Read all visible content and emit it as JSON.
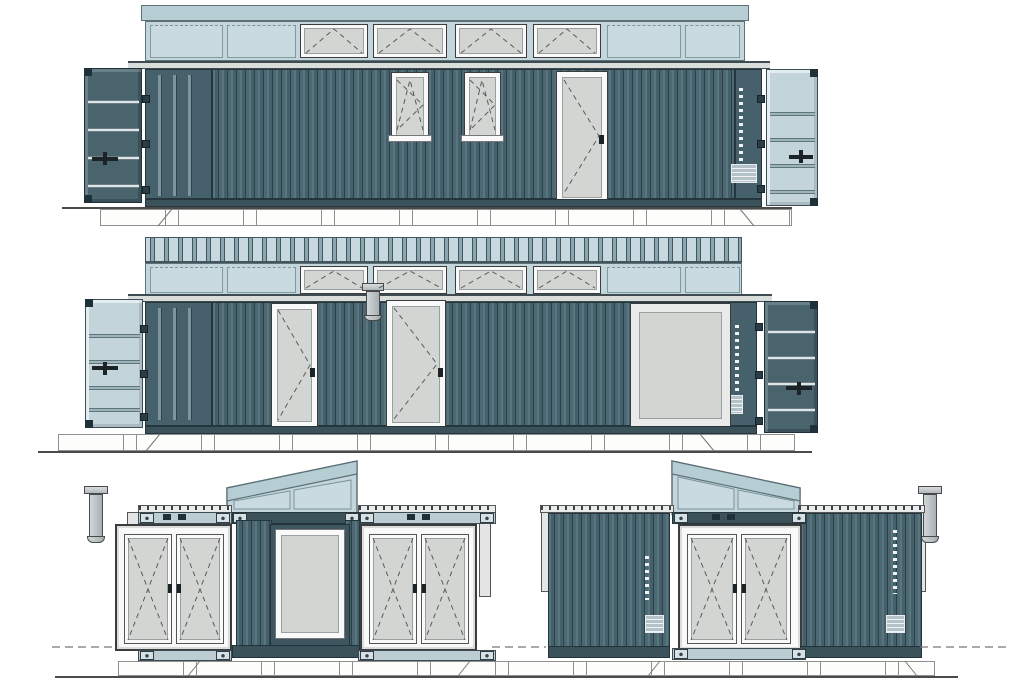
{
  "drawing": {
    "kind": "architectural elevation set",
    "subject": "shipping-container cabin with clerestory roof",
    "views": [
      {
        "id": "long-elevation-front",
        "position": "top",
        "clerestory": {
          "fixed_panels": 4,
          "awning_windows": 4
        },
        "wall": {
          "tilt_turn_windows": 2,
          "entrance_doors": 1
        },
        "open_container_doors": {
          "left": "dark",
          "right": "light"
        }
      },
      {
        "id": "long-elevation-rear",
        "position": "middle",
        "clerestory": {
          "fixed_panels": 4,
          "awning_windows": 4,
          "roof_deck_visible": true,
          "downpipes": 1
        },
        "wall": {
          "entrance_doors": 2,
          "picture_windows": 1
        },
        "open_container_doors": {
          "left": "light",
          "right": "dark"
        }
      },
      {
        "id": "end-elevation-left",
        "position": "bottom-left",
        "monopitch_clerestory": {
          "slope": "up-to-right",
          "glazed_panels": 2
        },
        "container_ends": {
          "french_door_sets": 2,
          "recessed_bay_glazed_panel": 1,
          "downpipes": 1
        }
      },
      {
        "id": "end-elevation-right",
        "position": "bottom-right",
        "monopitch_clerestory": {
          "slope": "down-to-right",
          "glazed_panels": 2
        },
        "container_ends": {
          "french_door_sets": 1,
          "corrugated_panels": 2,
          "downpipes": 1
        }
      }
    ]
  },
  "palette": {
    "paper": "#ffffff",
    "wall_face": "#44606a",
    "wall_rib_light": "#587680",
    "wall_rib_dark": "#2b3f47",
    "wall_border": "#24363d",
    "clerestory_body": "#c3d6dc",
    "clerestory_border": "#5d7177",
    "fixed_panel": "#c9dbe0",
    "fixed_panel_border": "#7f99a1",
    "fascia": "#b6cdd4",
    "roofband_light": "#c7d9de",
    "roofband_mid": "#8aa6ae",
    "roofband_line": "#43565e",
    "eaves": "#dadedb",
    "eaves_line": "#3e4c52",
    "glass": "#d3d5d3",
    "frame_white": "#f8f9f8",
    "frame_line": "#3c3c3c",
    "door_dark": "#4a646e",
    "door_light": "#c3d5db",
    "bar_light": "#dde7ea",
    "hardware": "#1c2326",
    "hinge": "#2a3d44",
    "rail_dark": "#3b525a",
    "rail_light": "#bccdd3",
    "casting": "#d7e0e3",
    "pipe": "#b9bfc1",
    "foundation": "#fdfdfc",
    "foundation_line": "#8f8f8f",
    "ground": "#4a4a4a",
    "symbol": "#5a5a5a"
  }
}
